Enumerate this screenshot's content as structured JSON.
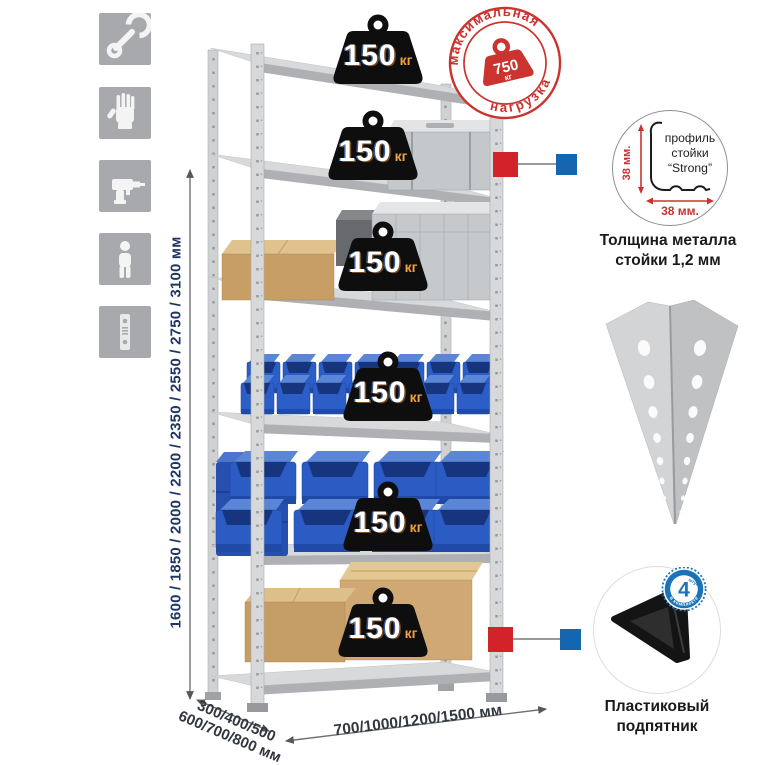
{
  "sidebar_icons": [
    {
      "name": "wrench"
    },
    {
      "name": "gloves"
    },
    {
      "name": "drill"
    },
    {
      "name": "person"
    },
    {
      "name": "upright-profile"
    }
  ],
  "dimensions": {
    "height_label": "1600 / 1850 / 2000 / 2200 / 2350 / 2550 / 2750 / 3100 мм",
    "depth_label": "300/400/500\n600/700/800 мм",
    "width_label": "700/1000/1200/1500 мм"
  },
  "shelf_badges": {
    "items": [
      {
        "value": "150",
        "unit": "кг"
      },
      {
        "value": "150",
        "unit": "кг"
      },
      {
        "value": "150",
        "unit": "кг"
      },
      {
        "value": "150",
        "unit": "кг"
      },
      {
        "value": "150",
        "unit": "кг"
      },
      {
        "value": "150",
        "unit": "кг"
      }
    ]
  },
  "max_load_stamp": {
    "arc_top": "максимальная",
    "arc_bottom": "нагрузка",
    "value": "750",
    "unit": "кг"
  },
  "profile_detail": {
    "note_line1": "профиль",
    "note_line2": "стойки",
    "note_line3": "“Strong”",
    "height_label": "38 мм.",
    "width_label": "38 мм.",
    "caption": "Толщина металла\nстойки 1,2 мм"
  },
  "foot_detail": {
    "count": "4",
    "count_unit": "штуки",
    "ring_text": "в комплекте",
    "caption": "Пластиковый\nподпятник"
  },
  "colors": {
    "accent_red": "#cb332e",
    "accent_blue": "#1b74ba",
    "marker_red": "#d2232a",
    "marker_blue": "#1566b0",
    "badge_black": "#0e0e0e",
    "badge_unit_orange": "#f2a13e",
    "bin_blue": "#2b5ec6",
    "dim_text": "#1e3666"
  }
}
